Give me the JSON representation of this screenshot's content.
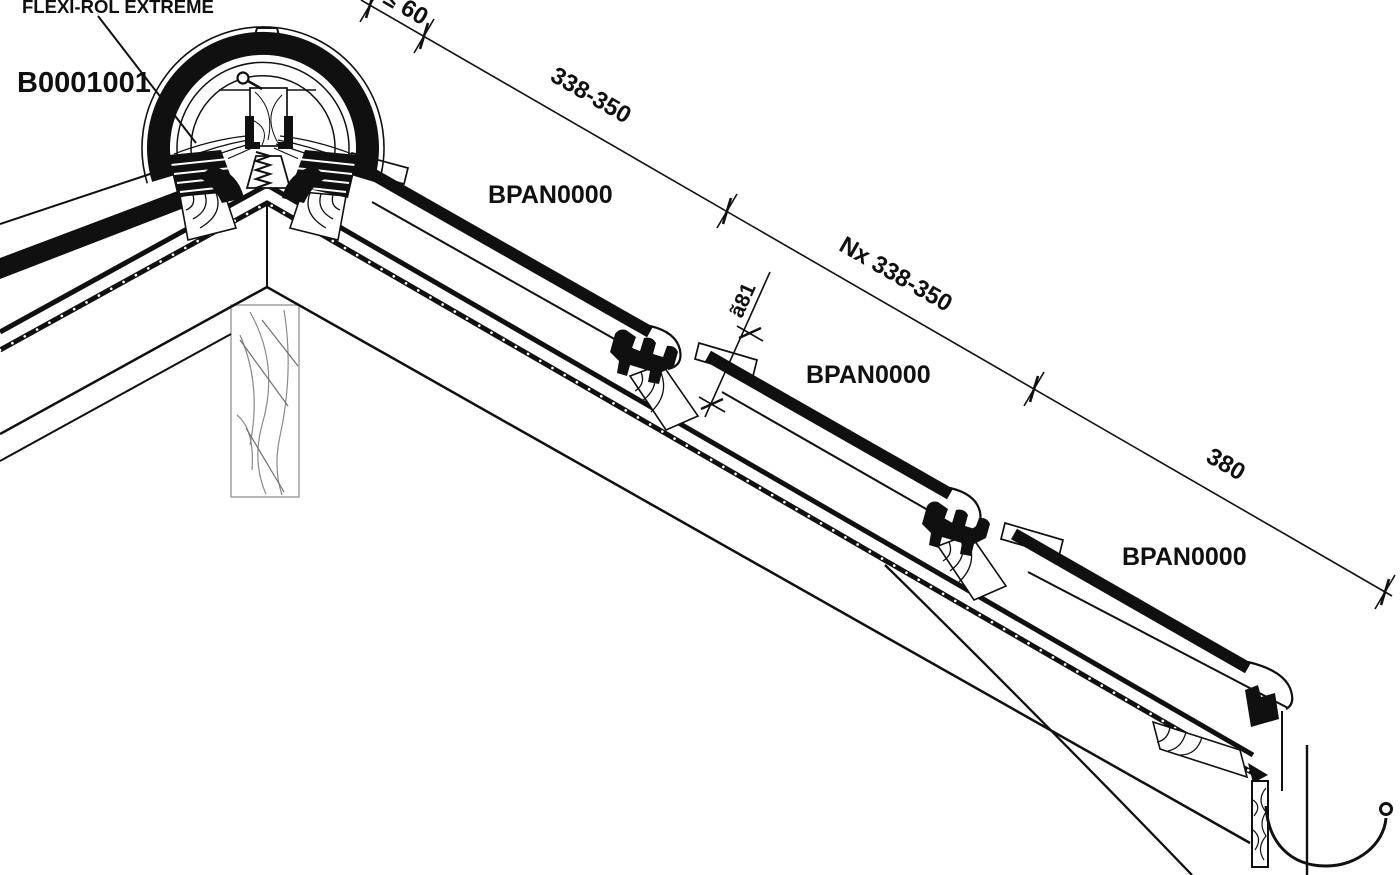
{
  "drawing": {
    "labels": {
      "flexi_rol": "FLEXI-ROL EXTREME",
      "ridge_tile_code": "B0001001",
      "pan_tile_code_1": "BPAN0000",
      "pan_tile_code_2": "BPAN0000",
      "pan_tile_code_3": "BPAN0000"
    },
    "dimensions": {
      "ridge_to_first_batten": "≤ 60",
      "first_batten_spacing": "338-350",
      "intermediate_batten_spacing": "Nx 338-350",
      "eaves_batten_spacing": "380",
      "head_overlap": "ã81"
    },
    "colors": {
      "ink": "#101010",
      "paper": "#ffffff",
      "grain": "#8a8a8a"
    }
  }
}
